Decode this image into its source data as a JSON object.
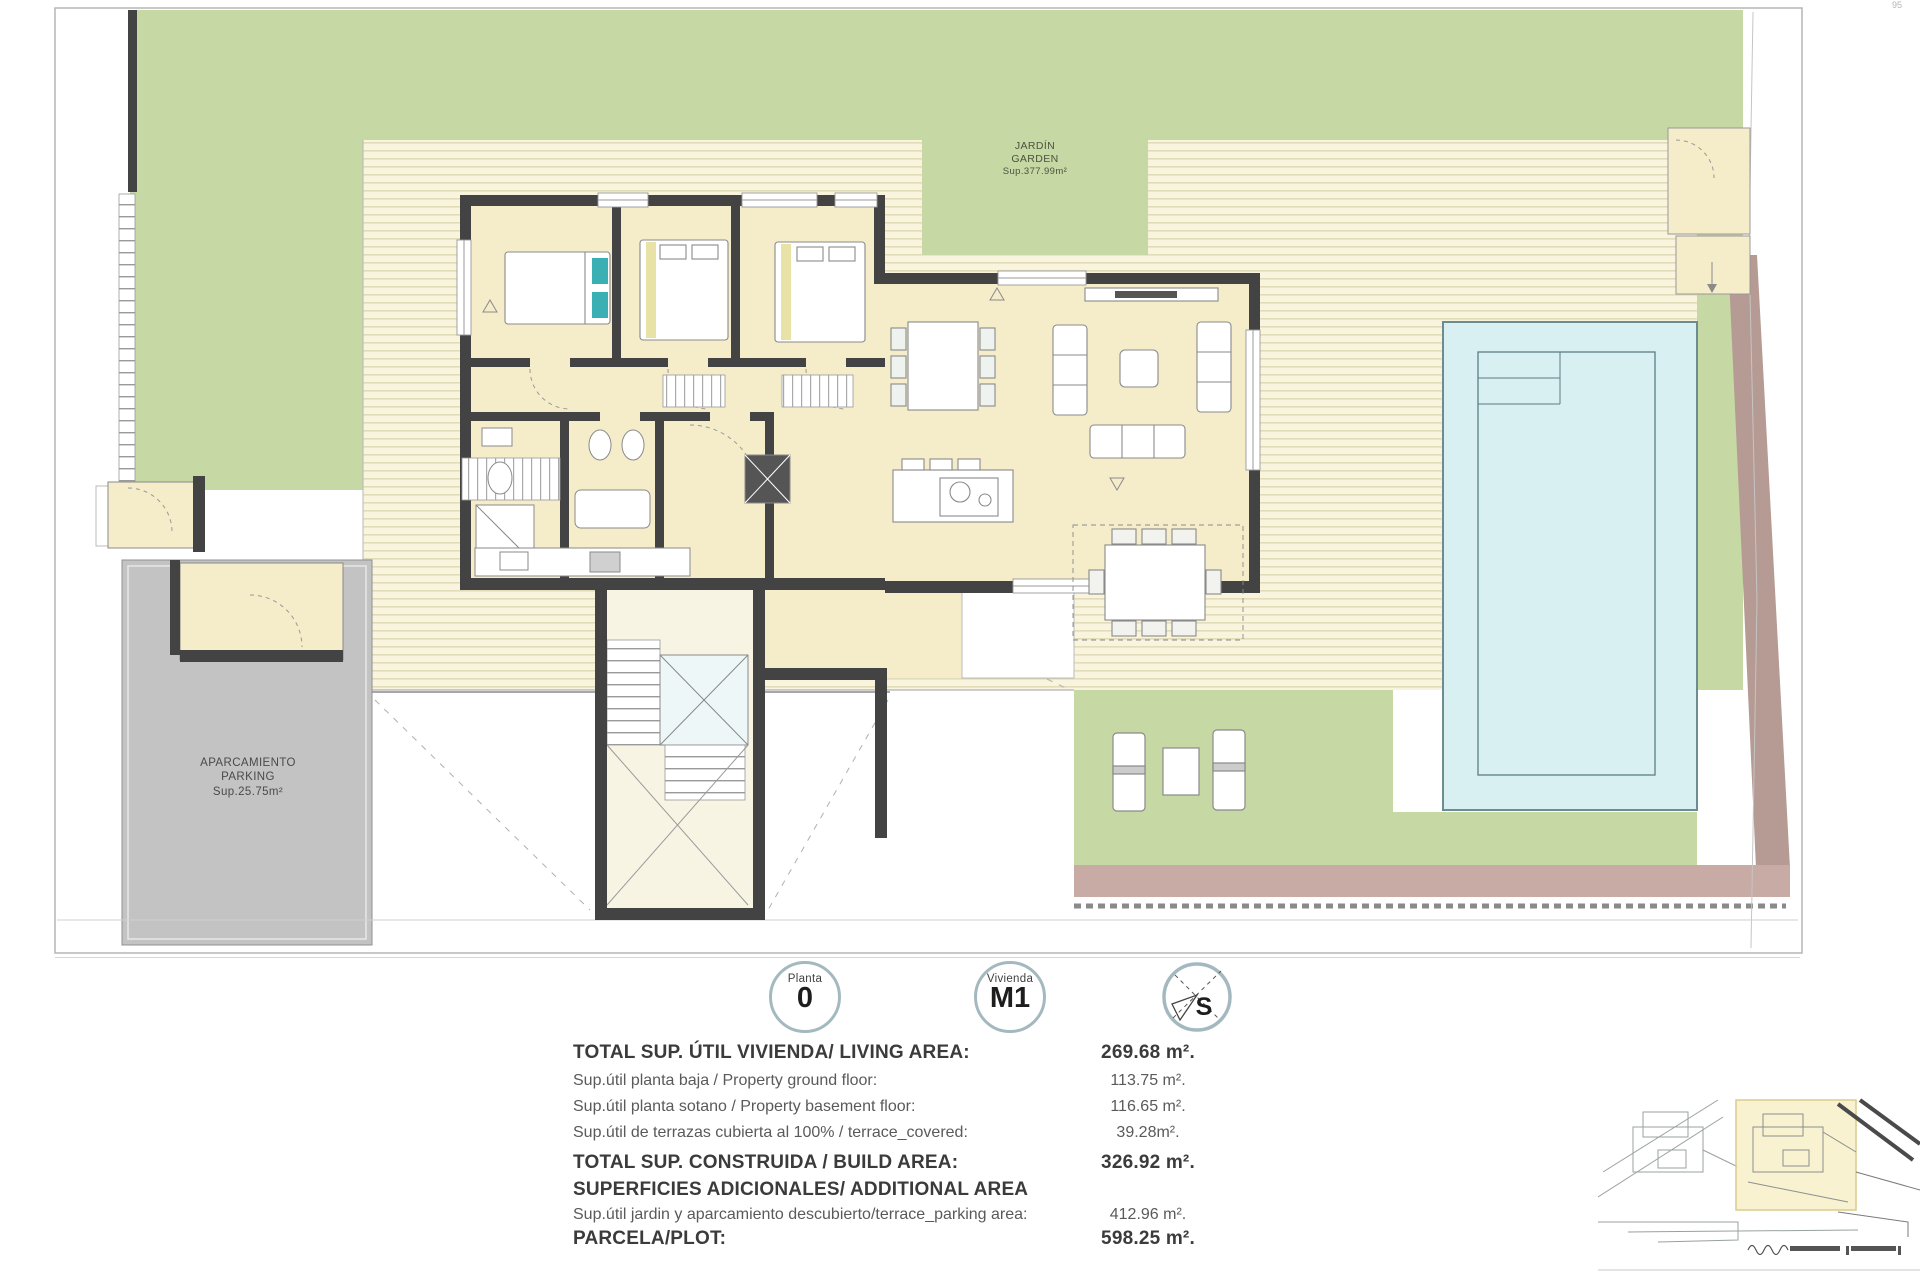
{
  "plan": {
    "garden_label": {
      "line1": "JARDÍN",
      "line2": "GARDEN",
      "line3": "Sup.377.99m²"
    },
    "parking_label": {
      "line1": "APARCAMIENTO",
      "line2": "PARKING",
      "line3": "Sup.25.75m²"
    },
    "corner_mark": "95"
  },
  "badges": {
    "floor": {
      "label": "Planta",
      "value": "0"
    },
    "unit": {
      "label": "Vivienda",
      "value": "M1"
    },
    "compass": {
      "letter": "S"
    }
  },
  "areas_table": {
    "rows": [
      {
        "label": "TOTAL SUP. ÚTIL  VIVIENDA/ LIVING AREA:",
        "value": "269.68 m²."
      },
      {
        "label": "Sup.útil planta baja / Property ground floor:",
        "value": "113.75 m²."
      },
      {
        "label": "Sup.útil planta sotano / Property basement floor:",
        "value": "116.65 m²."
      },
      {
        "label": "Sup.útil de terrazas cubierta al 100% / terrace_covered:",
        "value": "39.28m²."
      },
      {
        "label": "TOTAL SUP. CONSTRUIDA / BUILD AREA:",
        "value": "326.92 m²."
      },
      {
        "label": "SUPERFICIES ADICIONALES/ ADDITIONAL AREA",
        "value": ""
      },
      {
        "label": "Sup.útil jardin y aparcamiento descubierto/terrace_parking area:",
        "value": "412.96 m²."
      },
      {
        "label": "PARCELA/PLOT:",
        "value": "598.25 m²."
      }
    ]
  },
  "colors": {
    "garden": "#c6d8a3",
    "deck": "#f8f4de",
    "deck_line": "#ddd6b0",
    "floor": "#f5ecca",
    "wall": "#434343",
    "pool": "#d8f0f1",
    "pool_border": "#6d8c90",
    "parking": "#c3c3c3",
    "earth_strip": "#b59b93",
    "path_strip": "#c9aba6",
    "badge_ring": "#a4b8c0",
    "text": "#3f3f3f"
  }
}
